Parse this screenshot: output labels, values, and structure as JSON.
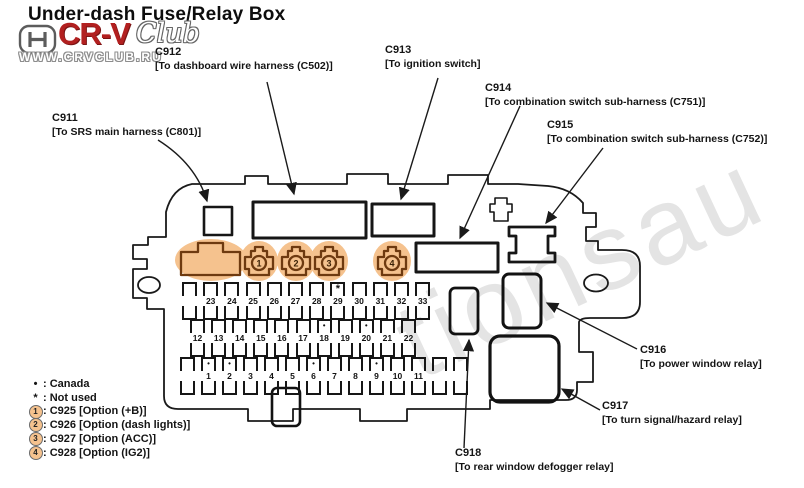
{
  "title": "Under-dash Fuse/Relay Box",
  "logo": {
    "honda_h": "H",
    "brand": "CR-V",
    "brand_suffix": "Club",
    "url": "WWW.CRVCLUB.RU"
  },
  "watermark": "tionsau",
  "callouts": [
    {
      "id": "C911",
      "desc": "[To SRS main harness (C801)]"
    },
    {
      "id": "C912",
      "desc": "[To dashboard wire harness (C502)]"
    },
    {
      "id": "C913",
      "desc": "[To ignition switch]"
    },
    {
      "id": "C914",
      "desc": "[To combination switch sub-harness (C751)]"
    },
    {
      "id": "C915",
      "desc": "[To combination switch sub-harness (C752)]"
    },
    {
      "id": "C916",
      "desc": "[To power window relay]"
    },
    {
      "id": "C917",
      "desc": "[To turn signal/hazard relay]"
    },
    {
      "id": "C918",
      "desc": "[To rear window defogger relay]"
    }
  ],
  "option_plugs": [
    {
      "n": "1"
    },
    {
      "n": "2"
    },
    {
      "n": "3"
    },
    {
      "n": "4"
    }
  ],
  "fusebox": {
    "rows": [
      {
        "name": "top",
        "slots": [
          {
            "n": ""
          },
          {
            "n": "23"
          },
          {
            "n": "24"
          },
          {
            "n": "25"
          },
          {
            "n": "26"
          },
          {
            "n": "27"
          },
          {
            "n": "28"
          },
          {
            "n": "29",
            "mark": "*"
          },
          {
            "n": "30"
          },
          {
            "n": "31"
          },
          {
            "n": "32"
          },
          {
            "n": "33"
          }
        ]
      },
      {
        "name": "middle",
        "slots": [
          {
            "n": "12"
          },
          {
            "n": "13"
          },
          {
            "n": "14"
          },
          {
            "n": "15"
          },
          {
            "n": "16"
          },
          {
            "n": "17"
          },
          {
            "n": "18",
            "mark": "•"
          },
          {
            "n": "19"
          },
          {
            "n": "20",
            "mark": "•"
          },
          {
            "n": "21"
          },
          {
            "n": "22"
          }
        ]
      },
      {
        "name": "bottom",
        "slots": [
          {
            "n": ""
          },
          {
            "n": "1",
            "mark": "•"
          },
          {
            "n": "2",
            "mark": "•"
          },
          {
            "n": "3"
          },
          {
            "n": "4"
          },
          {
            "n": "5"
          },
          {
            "n": "6",
            "mark": "•"
          },
          {
            "n": "7"
          },
          {
            "n": "8"
          },
          {
            "n": "9",
            "mark": "•"
          },
          {
            "n": "10"
          },
          {
            "n": "11"
          },
          {
            "n": ""
          },
          {
            "n": ""
          }
        ]
      }
    ]
  },
  "legend": {
    "items": [
      {
        "symbol": "•",
        "circled": false,
        "text": ": Canada"
      },
      {
        "symbol": "*",
        "circled": false,
        "text": ": Not used"
      },
      {
        "symbol": "1",
        "circled": true,
        "text": ": C925 [Option (+B)]"
      },
      {
        "symbol": "2",
        "circled": true,
        "text": ": C926 [Option (dash lights)]"
      },
      {
        "symbol": "3",
        "circled": true,
        "text": ": C927 [Option (ACC)]"
      },
      {
        "symbol": "4",
        "circled": true,
        "text": ": C928 [Option (IG2)]"
      }
    ]
  },
  "colors": {
    "highlight": "#f5c28e",
    "highlight_stroke": "#6e3a10",
    "line": "#1a1a1a",
    "logo_red": "#b22020",
    "watermark": "#e4e4e4"
  }
}
